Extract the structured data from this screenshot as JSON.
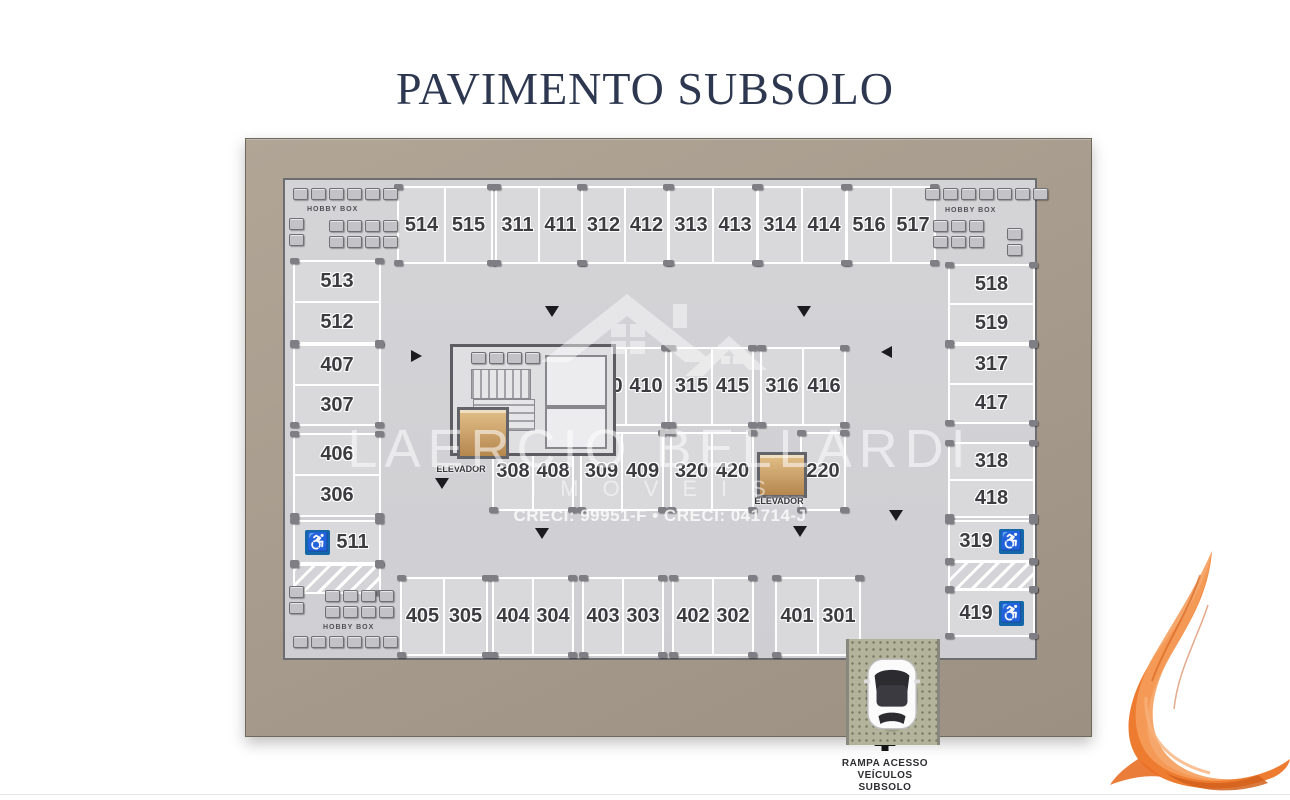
{
  "title": "PAVIMENTO SUBSOLO",
  "watermark": {
    "name": "LAERCIO BELLARDI",
    "subtitle": "IMÓVEIS",
    "creci": "CRECI: 99951-F • CRECI: 041714-J"
  },
  "plan": {
    "hobby_box_label": "HOBBY BOX",
    "elevator_label": "ELEVADOR",
    "top_row": [
      [
        "514",
        "515"
      ],
      [
        "311",
        "411"
      ],
      [
        "312",
        "412"
      ],
      [
        "313",
        "413"
      ],
      [
        "314",
        "414"
      ],
      [
        "516",
        "517"
      ]
    ],
    "left_column": [
      [
        "513",
        "512"
      ],
      [
        "407",
        "307"
      ],
      [
        "406",
        "306"
      ]
    ],
    "left_accessible": "511",
    "right_column": [
      [
        "518",
        "519"
      ],
      [
        "317",
        "417"
      ],
      [
        "318",
        "418"
      ]
    ],
    "right_accessible_top": "319",
    "right_accessible_bottom": "419",
    "mid_upper": [
      [
        "310",
        "410"
      ],
      [
        "315",
        "415"
      ],
      [
        "316",
        "416"
      ]
    ],
    "mid_lower": [
      [
        "308",
        "408"
      ],
      [
        "309",
        "409"
      ],
      [
        "320",
        "420"
      ]
    ],
    "mid_single": "220",
    "bottom_row": [
      [
        "405",
        "305"
      ],
      [
        "404",
        "304"
      ],
      [
        "403",
        "303"
      ],
      [
        "402",
        "302"
      ],
      [
        "401",
        "301"
      ]
    ],
    "ramp_caption": [
      "RAMPA ACESSO",
      "VEÍCULOS",
      "SUBSOLO"
    ],
    "accessible_icon": "♿"
  },
  "colors": {
    "title_navy": "#2d3850",
    "wall_taupe": "#a89c8e",
    "floor_gray": "#d1d1d5",
    "accessible_blue": "#1467a8",
    "swoosh_orange": "#ee7c30"
  }
}
